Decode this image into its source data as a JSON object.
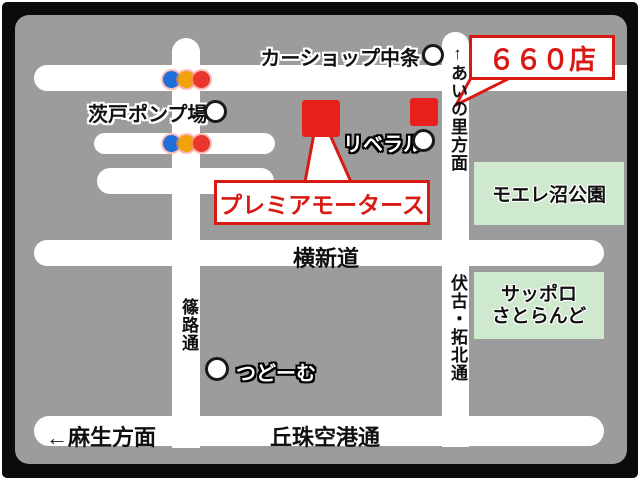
{
  "map": {
    "store_name_callout": "プレミアモータース",
    "store_number_callout": "６６０店",
    "road_labels": {
      "ainosato_direction": "↑あいの里方面",
      "shinoro_street": "篠路通",
      "fushiko_takuhoku_street": "伏古・拓北通",
      "yokoshindo": "横新道",
      "okadama_airport_street": "丘珠空港通",
      "asabu_direction": "←麻生方面"
    },
    "landmarks": {
      "carshop_nakajo": "カーショップ中条",
      "ibarato_pump_station": "茨戸ポンプ場",
      "liberal": "リベラル",
      "tsudome": "つどーむ",
      "moere_numa_park": "モエレ沼公園",
      "sapporo_satoland_line1": "サッポロ",
      "sapporo_satoland_line2": "さとらんど"
    },
    "colors": {
      "map_background": "#9c9c9c",
      "road": "#ffffff",
      "frame": "#0b0b0b",
      "callout_red": "#d81a15",
      "marker_red": "#e8211c",
      "park_green": "#cfe9cf",
      "traffic_blue": "#1f6fd8",
      "traffic_amber": "#f2a20d",
      "traffic_red": "#e8352e"
    }
  }
}
